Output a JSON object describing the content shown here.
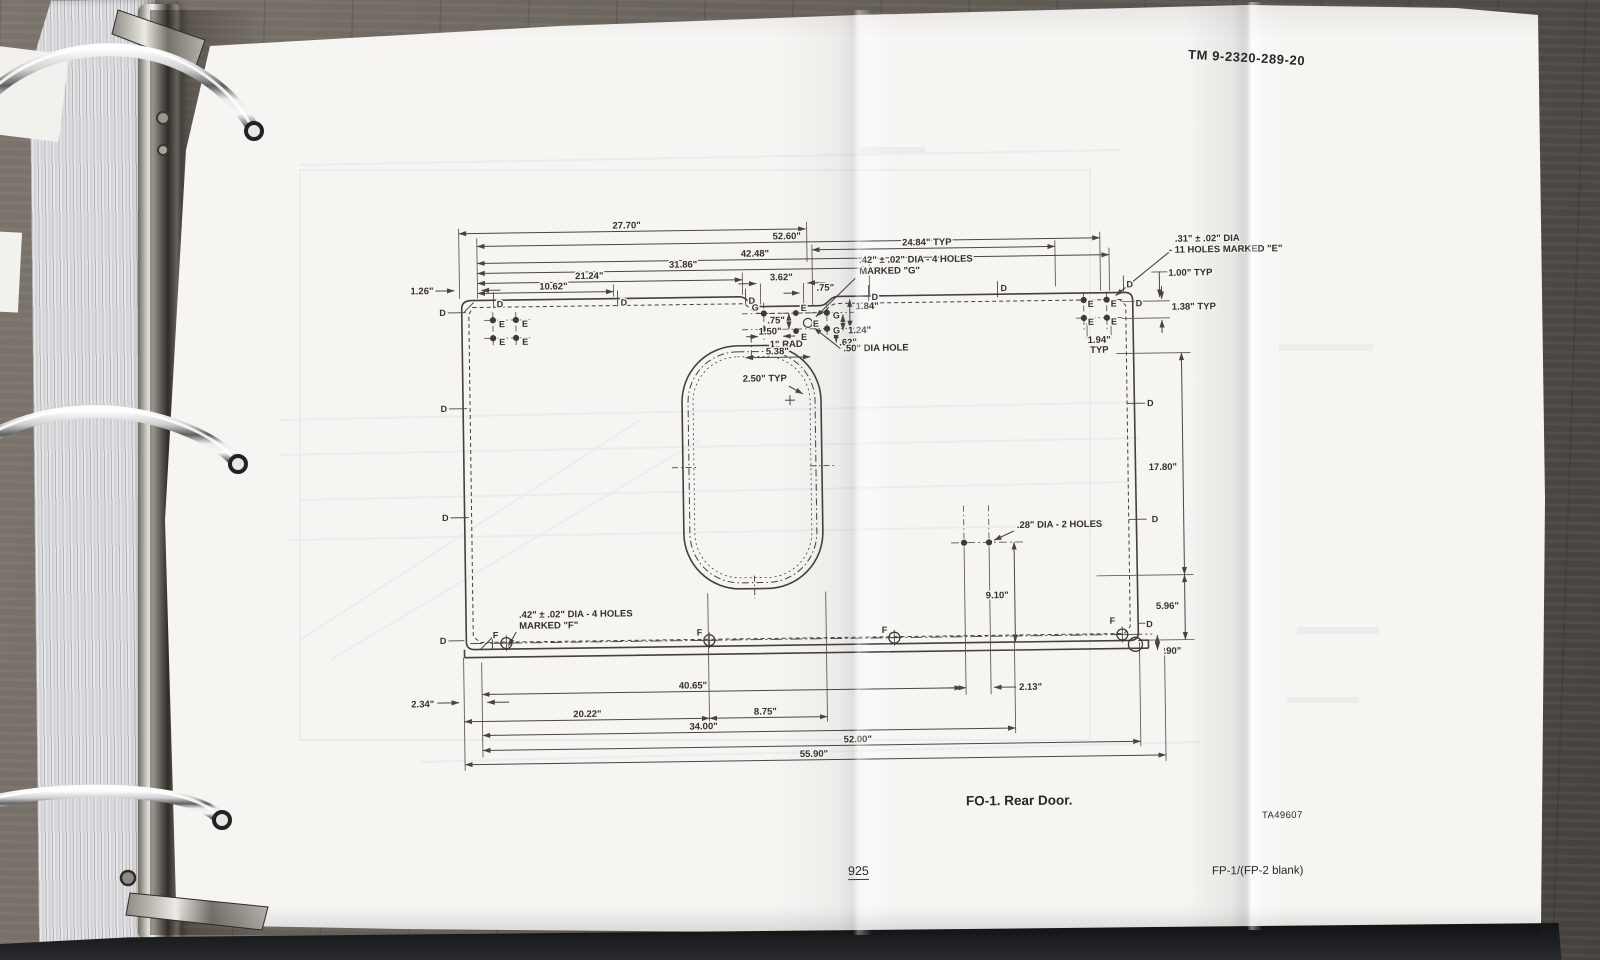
{
  "page": {
    "header_tm": "TM  9-2320-289-20",
    "figure_caption": "FO-1. Rear Door.",
    "figure_ref": "TA49607",
    "page_number": "925",
    "footer_right": "FP-1/(FP-2 blank)"
  },
  "drawing": {
    "dims": {
      "d2770": "27.70\"",
      "d5260": "52.60\"",
      "d2484": "24.84\" TYP",
      "d4248": "42.48\"",
      "d3186": "31.86\"",
      "d2124": "21.24\"",
      "d1062": "10.62\"",
      "d126": "1.26\"",
      "d362": "3.62\"",
      "d075top": ".75\"",
      "d184": "1.84\"",
      "d075v": ".75\"",
      "d150": "1.50\"",
      "d124": "1.24\"",
      "d062": ".62\"",
      "d1rad": "1\" RAD",
      "d538": "5.38\"",
      "d250typ": "2.50\" TYP",
      "d100typ": "1.00\" TYP",
      "d138typ": "1.38\" TYP",
      "d194": "1.94\"",
      "typ": "TYP",
      "d1780": "17.80\"",
      "d596": "5.96\"",
      "d090": ".90\"",
      "d910": "9.10\"",
      "d234": "2.34\"",
      "d4065": "40.65\"",
      "d213": "2.13\"",
      "d2022": "20.22\"",
      "d875": "8.75\"",
      "d3400": "34.00\"",
      "d5200": "52.00\"",
      "d5590": "55.90\""
    },
    "callouts": {
      "g1": ".42\" ± .02\" DIA - 4 HOLES",
      "g2": "MARKED \"G\"",
      "e1": ".31\" ± .02\" DIA",
      "e2": "- 11 HOLES MARKED \"E\"",
      "f1": ".42\" ± .02\" DIA - 4 HOLES",
      "f2": "MARKED \"F\"",
      "hole50": ".50\" DIA HOLE",
      "holes28": ".28\" DIA - 2 HOLES"
    },
    "letters": {
      "d": "D",
      "e": "E",
      "f": "F",
      "g": "G"
    }
  }
}
